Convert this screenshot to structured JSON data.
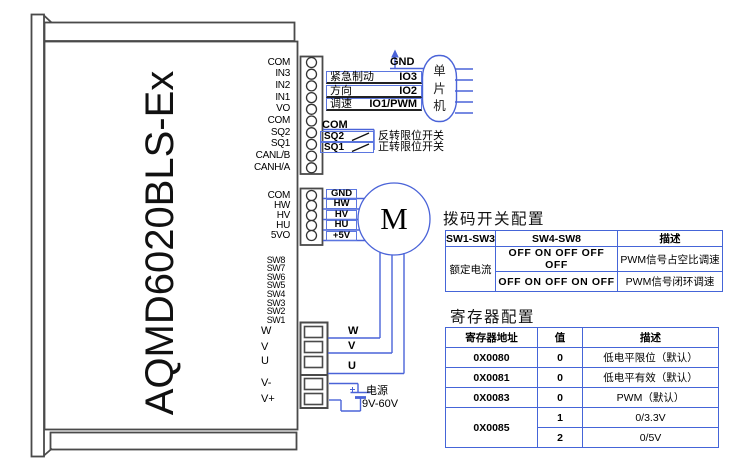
{
  "device": {
    "model": "AQMD6020BLS-Ex",
    "io_pins": [
      "COM",
      "IN3",
      "IN2",
      "IN1",
      "VO",
      "COM",
      "SQ2",
      "SQ1",
      "CANL/B",
      "CANH/A"
    ],
    "hall_pins": [
      "COM",
      "HW",
      "HV",
      "HU",
      "5VO"
    ],
    "dip_pins": [
      "SW8",
      "SW7",
      "SW6",
      "SW5",
      "SW4",
      "SW3",
      "SW2",
      "SW1"
    ],
    "power_pins": [
      "W",
      "V",
      "U",
      "V-",
      "V+"
    ]
  },
  "mcu": {
    "gnd": "GND",
    "name_chars": {
      "c0": "单",
      "c1": "片",
      "c2": "机"
    },
    "rows": [
      {
        "signal": "紧急制动",
        "io": "IO3"
      },
      {
        "signal": "方向",
        "io": "IO2"
      },
      {
        "signal": "调速",
        "io": "IO1/PWM"
      }
    ]
  },
  "limit": {
    "com": "COM",
    "rows": [
      {
        "pin": "SQ2",
        "label": "反转限位开关"
      },
      {
        "pin": "SQ1",
        "label": "正转限位开关"
      }
    ]
  },
  "motor": {
    "symbol": "M",
    "hall_wires": [
      "GND",
      "HW",
      "HV",
      "HU",
      "+5V"
    ],
    "phase_wires": [
      "W",
      "V",
      "U"
    ]
  },
  "power_supply": {
    "name": "电源",
    "range": "9V-60V"
  },
  "dip_table": {
    "title": "拨码开关配置",
    "headers": [
      "SW1-SW3",
      "SW4-SW8",
      "描述"
    ],
    "col1": "额定电流",
    "rows": [
      {
        "sw": "OFF ON OFF OFF OFF",
        "desc": "PWM信号占空比调速"
      },
      {
        "sw": "OFF ON OFF ON OFF",
        "desc": "PWM信号闭环调速"
      }
    ]
  },
  "reg_table": {
    "title": "寄存器配置",
    "headers": [
      "寄存器地址",
      "值",
      "描述"
    ],
    "rows": [
      {
        "addr": "0X0080",
        "value": "0",
        "desc": "低电平限位（默认）"
      },
      {
        "addr": "0X0081",
        "value": "0",
        "desc": "低电平有效（默认）"
      },
      {
        "addr": "0X0083",
        "value": "0",
        "desc": "PWM（默认）"
      }
    ],
    "multi": {
      "addr": "0X0085",
      "options": [
        {
          "value": "1",
          "desc": "0/3.3V"
        },
        {
          "value": "2",
          "desc": "0/5V"
        }
      ]
    }
  },
  "colors": {
    "wire_blue": "#4a63d8",
    "outline_gray": "#4a4a4a",
    "box_blue": "#5b76e0",
    "table_blue": "#4565d8"
  }
}
